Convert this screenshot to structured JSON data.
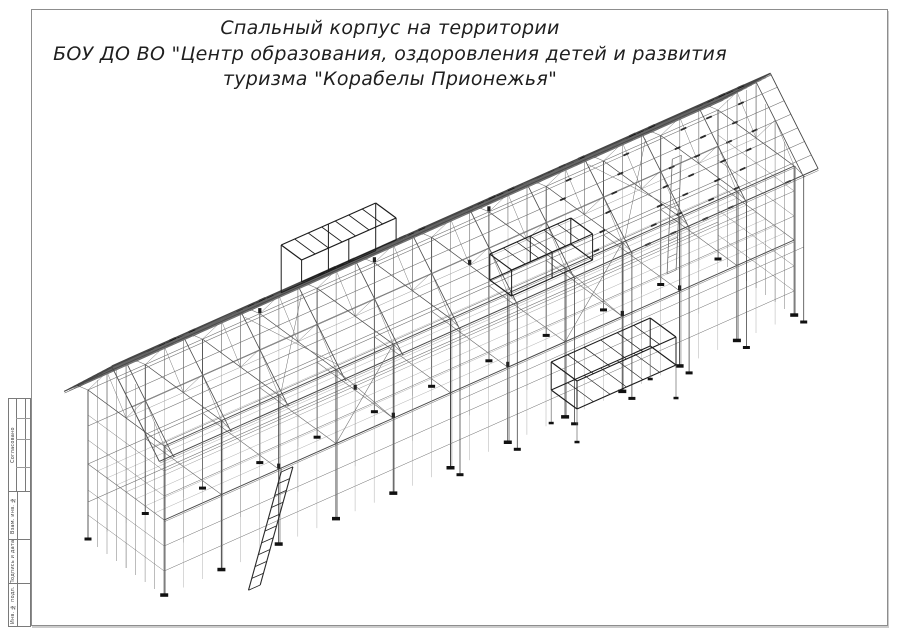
{
  "title": {
    "line1": "Спальный корпус на территории",
    "line2": "БОУ ДО ВО \"Центр образования, оздоровления детей и развития",
    "line3": "туризма \"Корабелы Прионежья\""
  },
  "title_block": {
    "agreed_label": "Согласовано",
    "replacement_inv_label": "Взам. инв. №",
    "signature_date_label": "Подпись и дата",
    "inventory_label": "Инв. № подл."
  },
  "drawing": {
    "origin": [
      88,
      540
    ],
    "u_axis": [
      0.9,
      -0.4
    ],
    "v_axis": [
      0.68,
      0.5
    ],
    "length": 700,
    "width": 112,
    "bays": 11,
    "level1_h": 76,
    "eave_h": 150,
    "eave_edge_h": 146,
    "ridge_h": 206,
    "ridge_v": 56,
    "back_eave_v": -14,
    "front_eave_v": 126,
    "gable_overhang": 16,
    "back_purlins": 11,
    "front_purlins": 7,
    "porch_start_bay": 5,
    "colors": {
      "main": "#474747",
      "mid": "#6b6b6b",
      "light": "#9a9a9a",
      "dark": "#1c1c1c",
      "ink": "#141414",
      "plate": "#111111"
    },
    "stair": {
      "top_u": 130,
      "top_v": 112,
      "top_h": 72,
      "bot_u": 62,
      "bot_v": 154,
      "bot_h": 2,
      "steps": 10
    },
    "stair2": {
      "top_u": 622,
      "top_v": 36,
      "top_h": 150,
      "bot_u": 580,
      "bot_v": 84,
      "bot_h": 76,
      "steps": 7
    },
    "roof_box_a": {
      "u1": 195,
      "u2": 300,
      "v1": 26,
      "v2": 56,
      "top_h": 230
    },
    "roof_box_b": {
      "u1": 380,
      "u2": 470,
      "v1": 88,
      "v2": 120,
      "top_h": 178,
      "bot_h": 152
    },
    "canopy": {
      "u1": 430,
      "u2": 540,
      "v1": 112,
      "v2": 150,
      "top_h": 62,
      "bot_h": 34
    }
  }
}
